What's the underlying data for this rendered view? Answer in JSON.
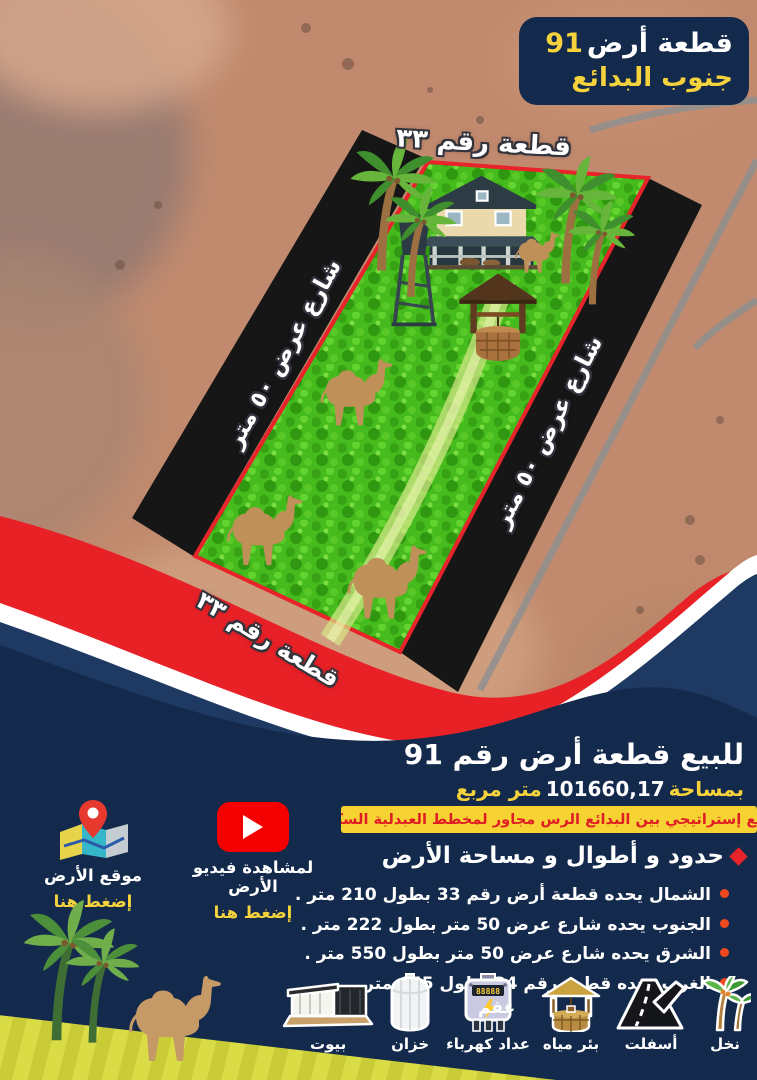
{
  "badge": {
    "title": "قطعة أرض",
    "number": "91",
    "subtitle": "جنوب البدائع"
  },
  "plot": {
    "top_label": "قطعة رقم ٣٣",
    "bottom_label": "قطعة رقم ٣٣",
    "left_road_label": "شارع عرض ٥٠ متر",
    "right_road_label": "شارع عرض ٥٠ متر"
  },
  "sale": {
    "title": "للبيع قطعة أرض رقم 91",
    "area_prefix": "بمساحة",
    "area_value": "101660,17",
    "area_suffix": "متر مربع",
    "location_note": "موقع إستراتيجي بين البدائع الرس مجاور لمخطط العبدلية السكني"
  },
  "details": {
    "heading": "حدود و أطوال و مساحة الأرض",
    "items": [
      "الشمال يحده قطعة أرض رقم 33 بطول 210 متر .",
      "الجنوب يحده شارع عرض 50 متر بطول 222 متر .",
      "الشرق يحده شارع عرض 50 متر بطول 550 متر .",
      "الغرب يحده قطعة رقم 34 بطول 455 متر."
    ]
  },
  "cta": {
    "map_label": "موقع الأرض",
    "map_click": "إضغط هنا",
    "video_label": "لمشاهدة فيديو الأرض",
    "video_click": "إضغط هنا"
  },
  "features": {
    "watermark": "عقم",
    "items": [
      {
        "label": "نخل",
        "icon": "palm-trees-icon"
      },
      {
        "label": "أسفلت",
        "icon": "asphalt-road-icon"
      },
      {
        "label": "بئر مياه",
        "icon": "water-well-icon"
      },
      {
        "label": "عداد كهرباء",
        "icon": "electric-meter-icon"
      },
      {
        "label": "خزان",
        "icon": "water-tank-icon"
      },
      {
        "label": "بيوت",
        "icon": "houses-icon"
      }
    ]
  },
  "colors": {
    "navy": "#142a4c",
    "navy_band": "#1e3a63",
    "red": "#e82127",
    "yellow": "#f6d33c",
    "grass": "#46bb1e",
    "sand": "#c18a6e"
  }
}
